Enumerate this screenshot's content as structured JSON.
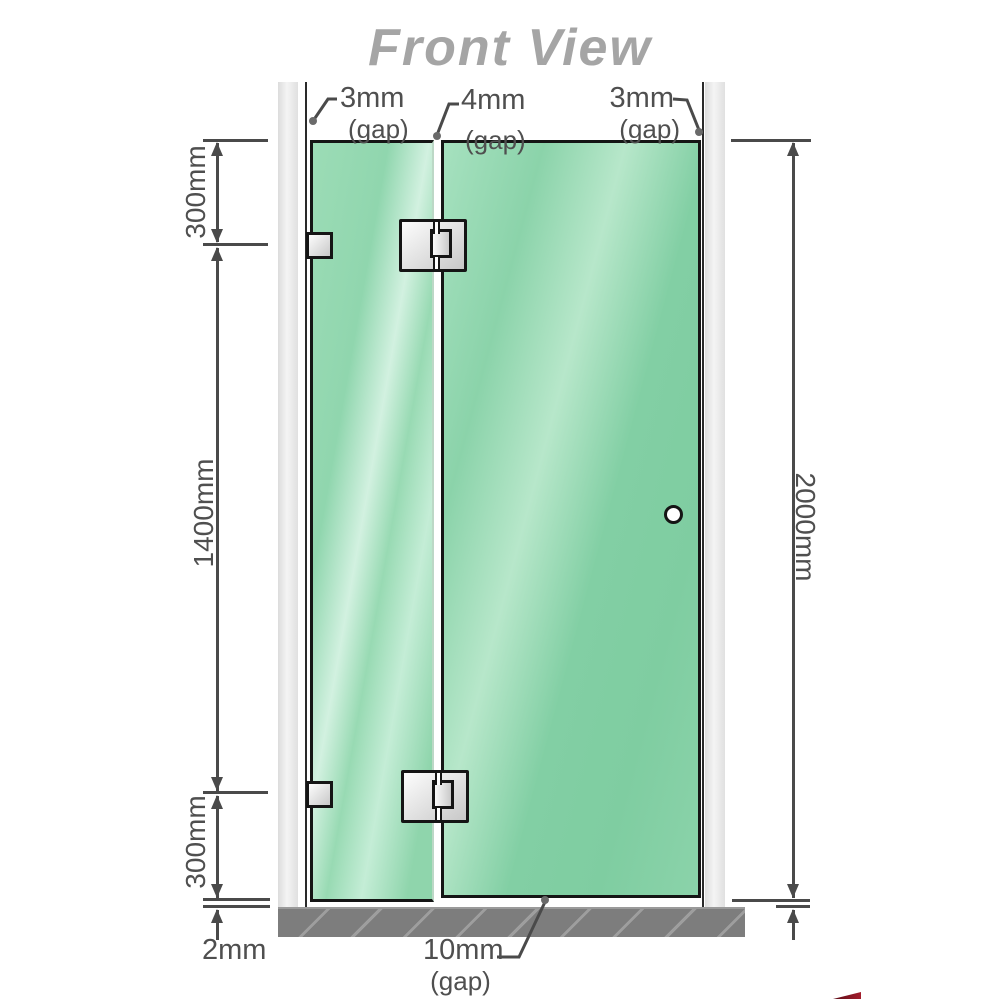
{
  "title": "Front View",
  "colors": {
    "glass_green": "#86cfa7",
    "wall_gray": "#e8e8e8",
    "base_gray": "#7d7d7d",
    "dimension_gray": "#4a4a4a",
    "title_gray": "#a5a5a5",
    "hardware_silver": "#d9d9d9"
  },
  "gap_labels": {
    "top_left": {
      "value": "3mm",
      "suffix": "(gap)"
    },
    "top_middle": {
      "value": "4mm",
      "suffix": "(gap)"
    },
    "top_right": {
      "value": "3mm",
      "suffix": "(gap)"
    },
    "bottom": {
      "value": "10mm",
      "suffix": "(gap)"
    }
  },
  "dimension_labels": {
    "upper_left": "300mm",
    "middle_left": "1400mm",
    "lower_left": "300mm",
    "floor_gap": "2mm",
    "right_total": "2000mm"
  }
}
